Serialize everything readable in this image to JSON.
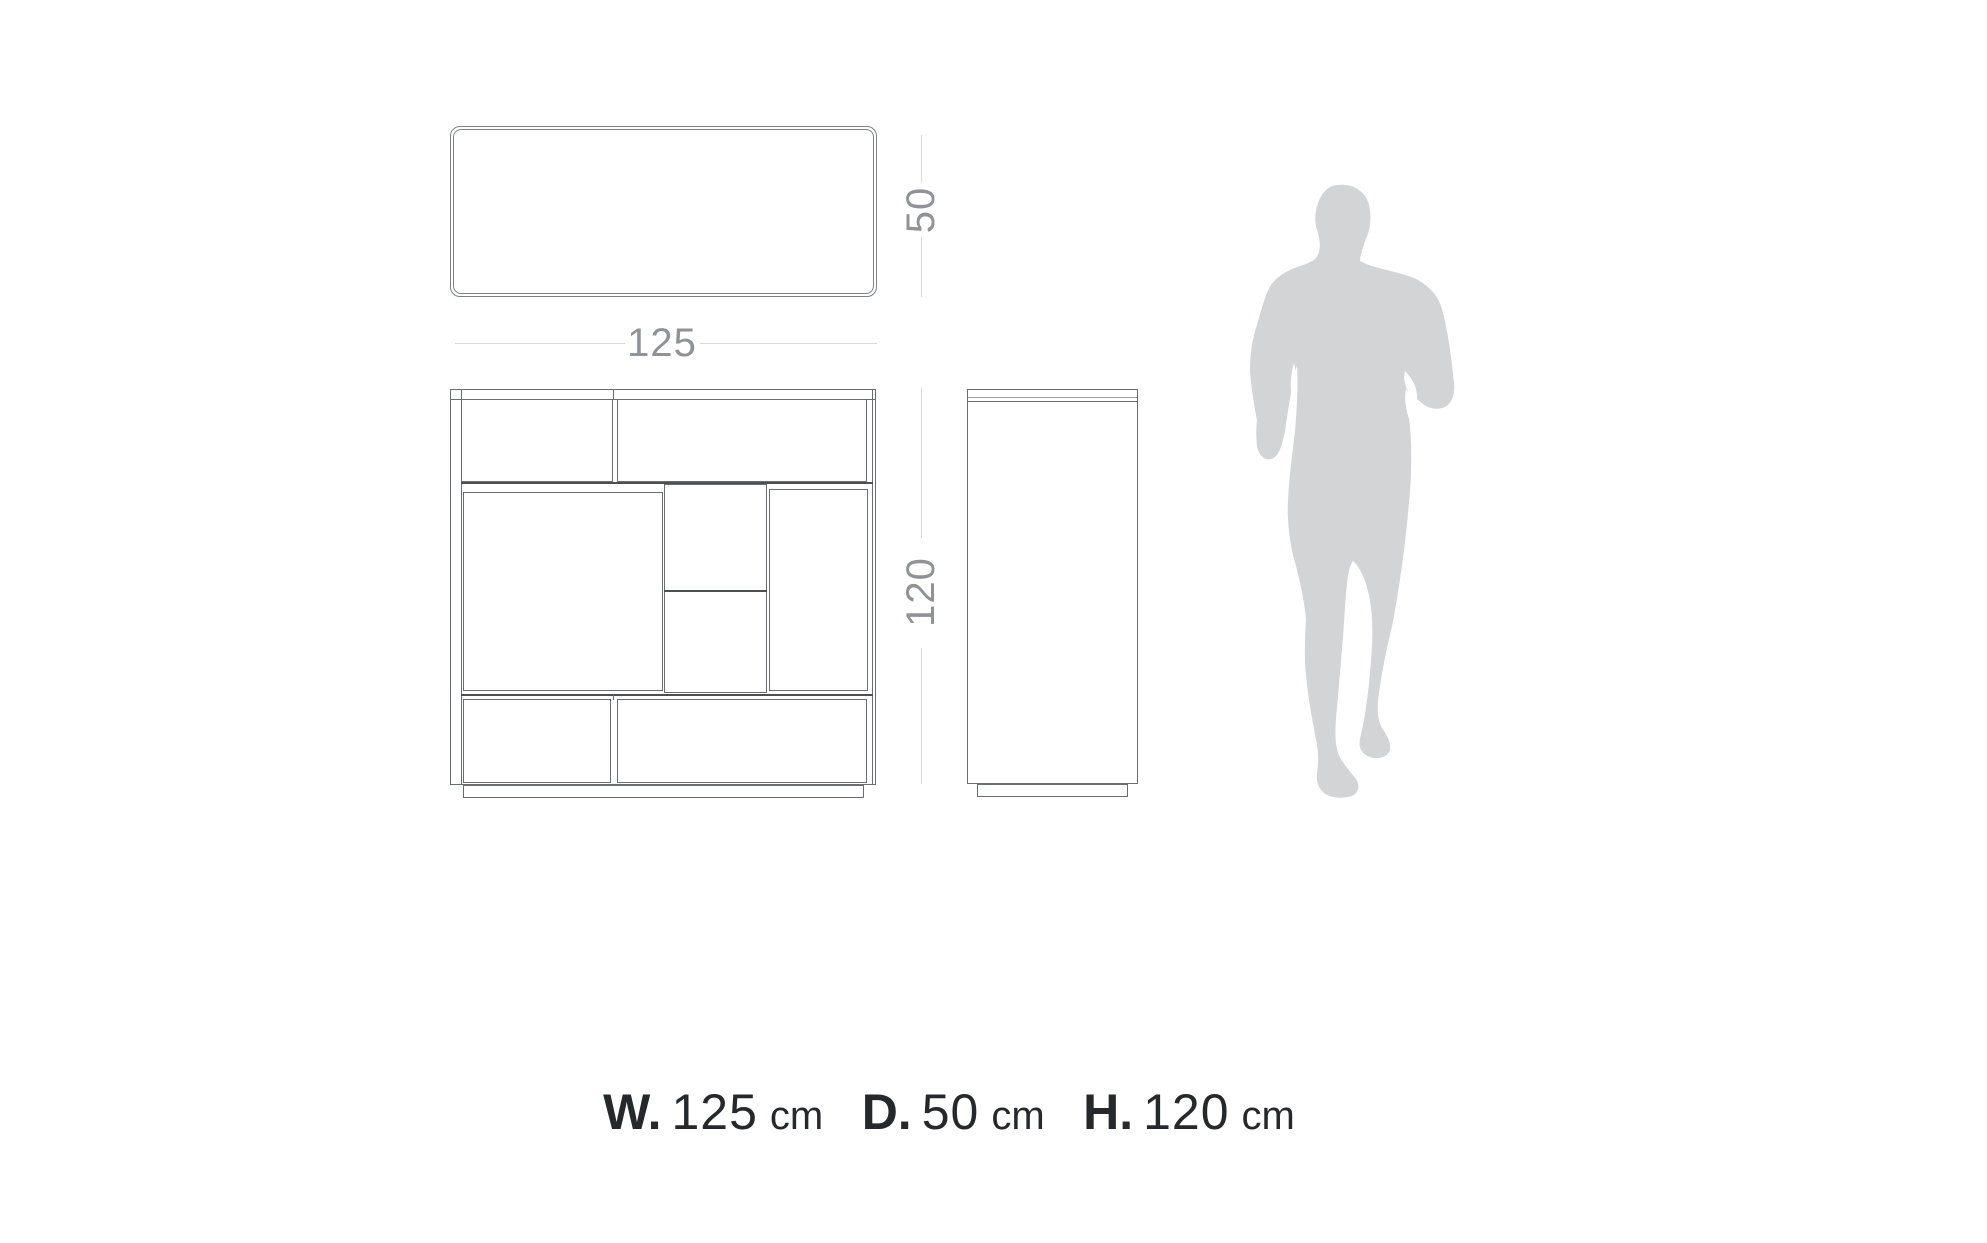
{
  "dimensions": {
    "width": "125",
    "depth": "50",
    "height": "120"
  },
  "footer": {
    "width": {
      "label": "W.",
      "value": "125",
      "unit": "cm"
    },
    "depth": {
      "label": "D.",
      "value": "50",
      "unit": "cm"
    },
    "height": {
      "label": "H.",
      "value": "120",
      "unit": "cm"
    }
  },
  "icons": {
    "scale_figure": "person-silhouette"
  },
  "colors": {
    "background": "#ffffff",
    "outline": "#6a6d71",
    "outline_dark": "#4d5053",
    "dimension_line": "#d9dadc",
    "dimension_text": "#8f9296",
    "footer_text": "#26292c",
    "silhouette": "#d3d4d6"
  }
}
